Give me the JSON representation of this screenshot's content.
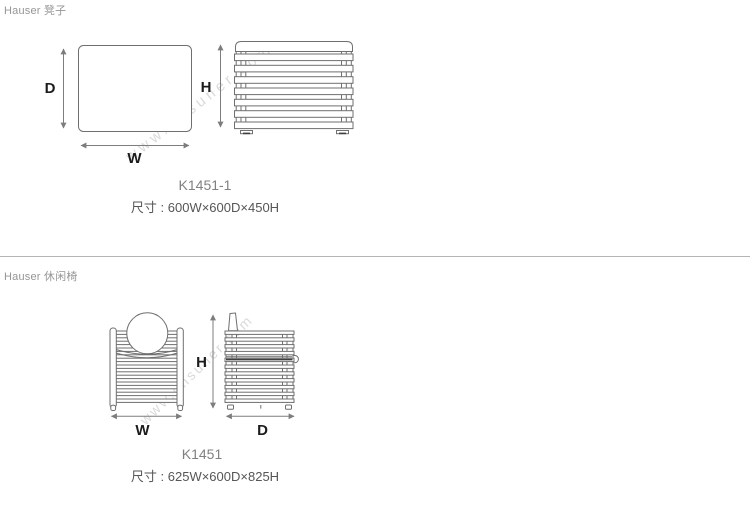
{
  "sections": [
    {
      "header": "Hauser 凳子",
      "model": "K1451-1",
      "size_text": "尺寸 : 600W×600D×450H",
      "labels": {
        "depth": "D",
        "width": "W",
        "height": "H"
      }
    },
    {
      "header": "Hauser 休闲椅",
      "model": "K1451",
      "size_text": "尺寸 : 625W×600D×825H",
      "labels": {
        "depth": "D",
        "width": "W",
        "height": "H"
      }
    }
  ],
  "watermark": "www.onsuner.com",
  "colors": {
    "background": "#ffffff",
    "header_text": "#969696",
    "model_text": "#818181",
    "size_text": "#565656",
    "dimension_label": "#1c1c1c",
    "drawing_line": "#6f6f6f",
    "divider": "#b5b5b5",
    "watermark": "#d8d8d8"
  }
}
